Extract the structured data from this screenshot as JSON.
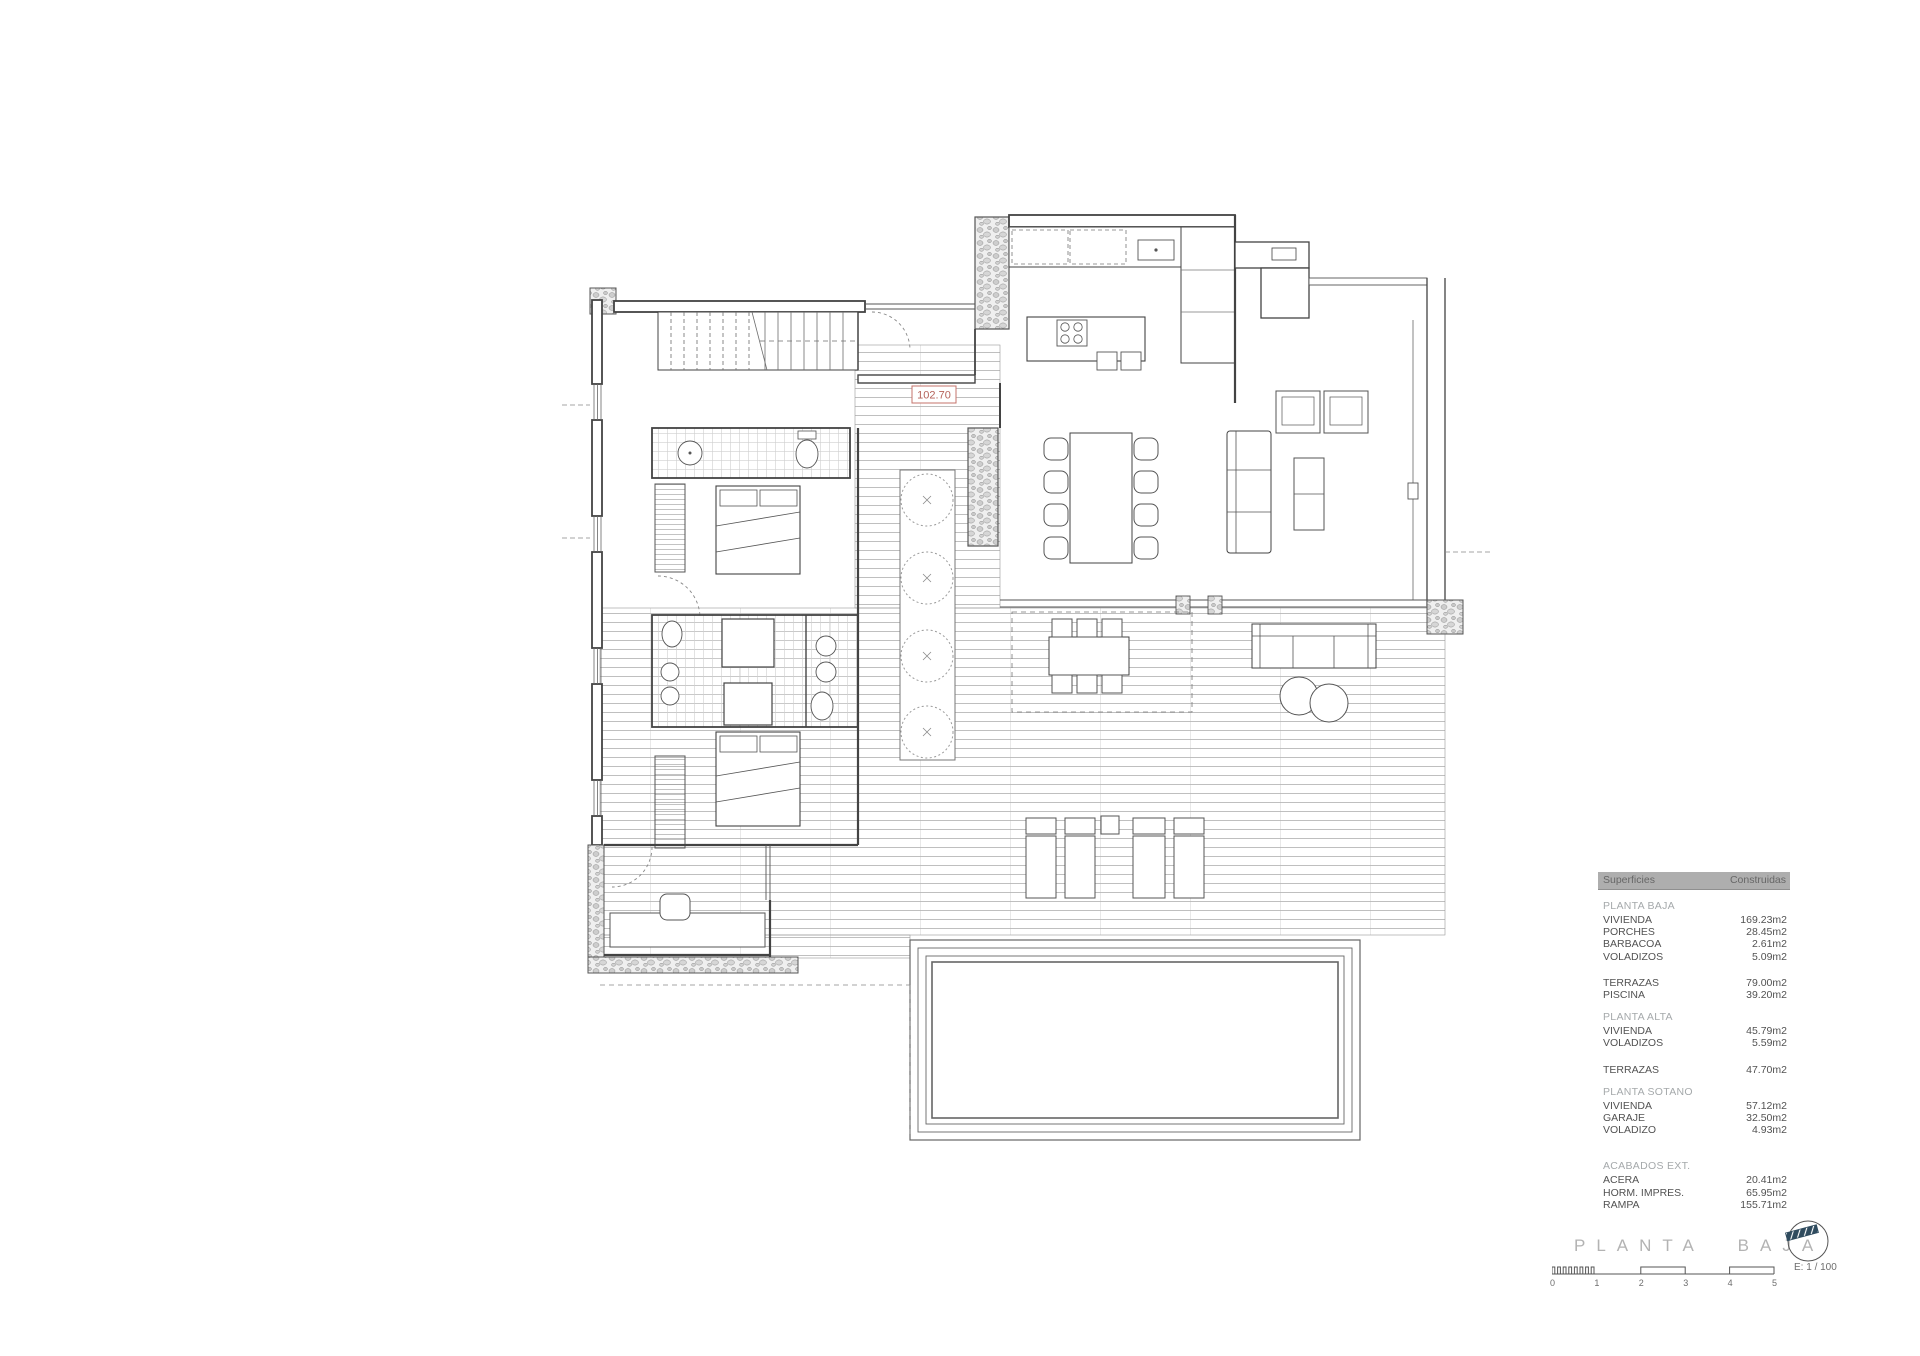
{
  "plan": {
    "level_label": "102.70"
  },
  "areas_table": {
    "header": {
      "col_left": "Superficies",
      "col_right": "Construidas"
    },
    "sections": [
      {
        "heading": "PLANTA BAJA",
        "rows": [
          [
            "VIVIENDA",
            "169.23m2"
          ],
          [
            "PORCHES",
            "28.45m2"
          ],
          [
            "BARBACOA",
            "2.61m2"
          ],
          [
            "VOLADIZOS",
            "5.09m2"
          ]
        ]
      },
      {
        "heading": "",
        "rows": [
          [
            "TERRAZAS",
            "79.00m2"
          ],
          [
            "PISCINA",
            "39.20m2"
          ]
        ]
      },
      {
        "heading": "PLANTA ALTA",
        "rows": [
          [
            "VIVIENDA",
            "45.79m2"
          ],
          [
            "VOLADIZOS",
            "5.59m2"
          ]
        ]
      },
      {
        "heading": "",
        "rows": [
          [
            "TERRAZAS",
            "47.70m2"
          ]
        ]
      },
      {
        "heading": "PLANTA SOTANO",
        "rows": [
          [
            "VIVIENDA",
            "57.12m2"
          ],
          [
            "GARAJE",
            "32.50m2"
          ],
          [
            "VOLADIZO",
            "4.93m2"
          ]
        ]
      },
      {
        "heading": "ACABADOS EXT.",
        "rows": [
          [
            "ACERA",
            "20.41m2"
          ],
          [
            "HORM. IMPRES.",
            "65.95m2"
          ],
          [
            "RAMPA",
            "155.71m2"
          ]
        ]
      }
    ]
  },
  "title_block": {
    "title": "PLANTA BAJA",
    "scale_label": "E: 1 / 100",
    "scale_ticks": [
      "0",
      "1",
      "2",
      "3",
      "4",
      "5"
    ]
  },
  "colors": {
    "accent_red": "#b5625a",
    "header_bar": "#aeaeae",
    "line": "#434343"
  }
}
